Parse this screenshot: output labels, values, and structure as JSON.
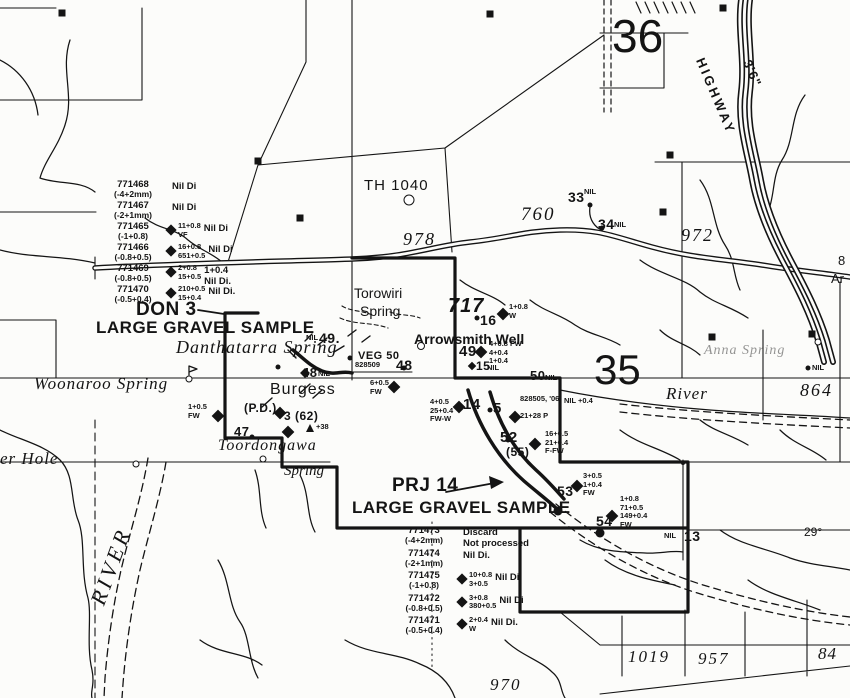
{
  "colors": {
    "ink": "#141414",
    "paper": "#fcfcfa"
  },
  "labels": [
    {
      "name": "section-number-36",
      "text": "36",
      "x": 612,
      "y": 12,
      "cls": "big",
      "fs": 46
    },
    {
      "name": "section-number-35",
      "text": "35",
      "x": 594,
      "y": 348,
      "cls": "big",
      "fs": 42
    },
    {
      "name": "label-th-1040",
      "text": "TH 1040",
      "x": 364,
      "y": 178,
      "cls": "typed",
      "fs": 15,
      "ls": 1
    },
    {
      "name": "elevation-978",
      "text": "978",
      "x": 403,
      "y": 230,
      "cls": "topo",
      "fs": 18,
      "ls": 2
    },
    {
      "name": "elevation-760",
      "text": "760",
      "x": 521,
      "y": 205,
      "cls": "topo",
      "fs": 19,
      "ls": 2
    },
    {
      "name": "elevation-972",
      "text": "972",
      "x": 681,
      "y": 226,
      "cls": "topo",
      "fs": 18,
      "ls": 2
    },
    {
      "name": "elevation-717",
      "text": "717",
      "x": 448,
      "y": 296,
      "cls": "hand-italic",
      "fs": 20
    },
    {
      "name": "elevation-864",
      "text": "864",
      "x": 800,
      "y": 381,
      "cls": "topo",
      "fs": 18,
      "ls": 2
    },
    {
      "name": "elevation-1019",
      "text": "1019",
      "x": 628,
      "y": 648,
      "cls": "topo",
      "fs": 17,
      "ls": 2
    },
    {
      "name": "elevation-957",
      "text": "957",
      "x": 698,
      "y": 650,
      "cls": "topo",
      "fs": 17,
      "ls": 2
    },
    {
      "name": "elevation-84",
      "text": "84",
      "x": 818,
      "y": 645,
      "cls": "topo",
      "fs": 17,
      "ls": 1
    },
    {
      "name": "elevation-970",
      "text": "970",
      "x": 490,
      "y": 676,
      "cls": "topo",
      "fs": 17,
      "ls": 2
    },
    {
      "name": "bearing-29",
      "text": "29°",
      "x": 804,
      "y": 526,
      "cls": "typed",
      "fs": 12
    },
    {
      "name": "edge-label-8",
      "text": "8",
      "x": 838,
      "y": 254,
      "cls": "typed",
      "fs": 13
    },
    {
      "name": "edge-label-ar",
      "text": "Ar",
      "x": 831,
      "y": 272,
      "cls": "typed",
      "fs": 13
    },
    {
      "name": "highway-label",
      "text": "HIGHWAY",
      "x": 706,
      "y": 56,
      "cls": "typed-bold",
      "fs": 13,
      "rot": 67,
      "ls": 3
    },
    {
      "name": "railway-gauge-label",
      "text": "3'6\"",
      "x": 753,
      "y": 58,
      "cls": "typed-bold",
      "fs": 13,
      "rot": 67,
      "ls": 1
    },
    {
      "name": "torowiri-spring-label",
      "text": "Torowiri",
      "x": 354,
      "y": 286,
      "cls": "typed",
      "fs": 14
    },
    {
      "name": "torowiri-spring-label-2",
      "text": "Spring",
      "x": 360,
      "y": 304,
      "cls": "typed",
      "fs": 14
    },
    {
      "name": "arrowsmith-well-label",
      "text": "Arrowsmith Well",
      "x": 414,
      "y": 332,
      "cls": "typed-bold",
      "fs": 14
    },
    {
      "name": "danthatarra-spring-label",
      "text": "Danthatarra  Spring",
      "x": 176,
      "y": 338,
      "cls": "name",
      "fs": 18,
      "ls": 1
    },
    {
      "name": "woonaroo-spring-label",
      "text": "Woonaroo  Spring",
      "x": 34,
      "y": 375,
      "cls": "name",
      "fs": 17,
      "ls": 1
    },
    {
      "name": "burgess-label",
      "text": "Burgess",
      "x": 270,
      "y": 382,
      "cls": "typed",
      "fs": 16,
      "ls": 1
    },
    {
      "name": "toordongawa-spring-label",
      "text": "Toordongawa",
      "x": 218,
      "y": 438,
      "cls": "name",
      "fs": 16,
      "ls": 1
    },
    {
      "name": "toordongawa-spring-label-2",
      "text": "Spring",
      "x": 284,
      "y": 464,
      "cls": "name",
      "fs": 15
    },
    {
      "name": "er-hole-label",
      "text": "er Hole",
      "x": 0,
      "y": 450,
      "cls": "name",
      "fs": 17,
      "ls": 1
    },
    {
      "name": "river-label",
      "text": "River",
      "x": 666,
      "y": 385,
      "cls": "name",
      "fs": 17,
      "ls": 1
    },
    {
      "name": "river-label-vertical",
      "text": "RIVER",
      "x": 86,
      "y": 600,
      "cls": "name",
      "fs": 22,
      "rot": -70,
      "ls": 4
    },
    {
      "name": "anna-spring-label",
      "text": "Anna Spring",
      "x": 704,
      "y": 344,
      "cls": "name",
      "fs": 14,
      "op": 0.45,
      "ls": 1
    },
    {
      "name": "don-3-label",
      "text": "DON 3",
      "x": 136,
      "y": 300,
      "cls": "hand",
      "fs": 19
    },
    {
      "name": "don-3-subtitle",
      "text": "LARGE GRAVEL SAMPLE",
      "x": 96,
      "y": 319,
      "cls": "hand",
      "fs": 17
    },
    {
      "name": "prj-14-label",
      "text": "PRJ 14",
      "x": 392,
      "y": 476,
      "cls": "hand",
      "fs": 19
    },
    {
      "name": "prj-14-subtitle",
      "text": "LARGE GRAVEL SAMPLE",
      "x": 352,
      "y": 499,
      "cls": "hand",
      "fs": 17
    },
    {
      "name": "station-49-nil-prefix",
      "text": "NIL",
      "x": 306,
      "y": 334,
      "cls": "tiny"
    },
    {
      "name": "station-49-label",
      "text": "49.",
      "x": 319,
      "y": 331,
      "cls": "hand",
      "fs": 14
    },
    {
      "name": "station-48b-label",
      "text": "48",
      "x": 302,
      "y": 366,
      "cls": "hand",
      "fs": 13
    },
    {
      "name": "station-48b-nil",
      "text": "NIL",
      "x": 318,
      "y": 370,
      "cls": "tiny"
    },
    {
      "name": "veg-50-label",
      "text": "VEG 50",
      "x": 358,
      "y": 351,
      "cls": "hand",
      "fs": 11
    },
    {
      "name": "sample-828509-label",
      "text": "828509",
      "x": 355,
      "y": 361,
      "cls": "tiny"
    },
    {
      "name": "station-48-label",
      "text": "48",
      "x": 396,
      "y": 358,
      "cls": "hand",
      "fs": 14
    },
    {
      "name": "annotation-6-05",
      "text": "6+0.5\nFW",
      "x": 370,
      "y": 379,
      "cls": "tiny"
    },
    {
      "name": "station-16-label",
      "text": "16",
      "x": 480,
      "y": 313,
      "cls": "hand",
      "fs": 14
    },
    {
      "name": "annotation-16",
      "text": "1+0.8\nW",
      "x": 509,
      "y": 303,
      "cls": "tiny"
    },
    {
      "name": "station-49-label-2",
      "text": "49",
      "x": 459,
      "y": 344,
      "cls": "hand",
      "fs": 15
    },
    {
      "name": "annotation-49",
      "text": "4+0.8 FW\n4+0.4\n1+0.4",
      "x": 489,
      "y": 340,
      "cls": "tiny"
    },
    {
      "name": "station-15-label",
      "text": "15",
      "x": 476,
      "y": 360,
      "cls": "hand",
      "fs": 12
    },
    {
      "name": "station-15-nil",
      "text": "NIL",
      "x": 487,
      "y": 364,
      "cls": "tiny"
    },
    {
      "name": "station-50-label",
      "text": "50",
      "x": 530,
      "y": 369,
      "cls": "hand",
      "fs": 13
    },
    {
      "name": "station-50-nil",
      "text": "NIL",
      "x": 545,
      "y": 374,
      "cls": "tiny"
    },
    {
      "name": "station-33-label",
      "text": "33",
      "x": 568,
      "y": 190,
      "cls": "hand",
      "fs": 14
    },
    {
      "name": "station-33-nil",
      "text": "NIL",
      "x": 584,
      "y": 188,
      "cls": "tiny"
    },
    {
      "name": "station-34-label",
      "text": "34",
      "x": 598,
      "y": 217,
      "cls": "hand",
      "fs": 14
    },
    {
      "name": "station-34-nil",
      "text": "NIL",
      "x": 614,
      "y": 221,
      "cls": "tiny"
    },
    {
      "name": "nil-annotation-east",
      "text": "NIL",
      "x": 812,
      "y": 364,
      "cls": "tiny"
    },
    {
      "name": "station-14-label",
      "text": "14",
      "x": 463,
      "y": 397,
      "cls": "hand",
      "fs": 15
    },
    {
      "name": "annotation-14",
      "text": "4+0.5\n25+0.4\nFW-W",
      "x": 430,
      "y": 398,
      "cls": "tiny"
    },
    {
      "name": "station-5-label",
      "text": "5",
      "x": 493,
      "y": 401,
      "cls": "hand",
      "fs": 15
    },
    {
      "name": "sample-828505-label",
      "text": "828505, '06",
      "x": 520,
      "y": 395,
      "cls": "tiny"
    },
    {
      "name": "annotation-nil-04",
      "text": "NIL +0.4",
      "x": 564,
      "y": 397,
      "cls": "tiny"
    },
    {
      "name": "annotation-5",
      "text": "21+28 P",
      "x": 520,
      "y": 412,
      "cls": "tiny"
    },
    {
      "name": "station-52-label",
      "text": "52",
      "x": 500,
      "y": 430,
      "cls": "hand",
      "fs": 15
    },
    {
      "name": "station-52-sub",
      "text": "(55)",
      "x": 506,
      "y": 446,
      "cls": "hand",
      "fs": 12
    },
    {
      "name": "annotation-52",
      "text": "16+0.5\n21+0.4\nF-FW",
      "x": 545,
      "y": 430,
      "cls": "tiny"
    },
    {
      "name": "station-53-label",
      "text": "53",
      "x": 557,
      "y": 484,
      "cls": "hand",
      "fs": 14
    },
    {
      "name": "annotation-53",
      "text": "3+0.5\n1+0.4\nFW",
      "x": 583,
      "y": 472,
      "cls": "tiny"
    },
    {
      "name": "station-54-label",
      "text": "54",
      "x": 596,
      "y": 514,
      "cls": "hand",
      "fs": 14
    },
    {
      "name": "annotation-54",
      "text": "1+0.8\n71+0.5\n149+0.4\nFW",
      "x": 620,
      "y": 495,
      "cls": "tiny"
    },
    {
      "name": "station-13-nil",
      "text": "NIL",
      "x": 664,
      "y": 532,
      "cls": "tiny"
    },
    {
      "name": "station-13-label",
      "text": "13",
      "x": 684,
      "y": 529,
      "cls": "hand",
      "fs": 14
    },
    {
      "name": "station-47-label",
      "text": "47",
      "x": 234,
      "y": 425,
      "cls": "hand",
      "fs": 13
    },
    {
      "name": "pd-label",
      "text": "(P.D.)",
      "x": 244,
      "y": 402,
      "cls": "hand",
      "fs": 12
    },
    {
      "name": "station-3-62-label",
      "text": "3 (62)",
      "x": 284,
      "y": 410,
      "cls": "hand",
      "fs": 12
    },
    {
      "name": "annotation-1-05",
      "text": "1+0.5\nFW",
      "x": 188,
      "y": 403,
      "cls": "tiny"
    },
    {
      "name": "annotation-plus-38",
      "text": "+38",
      "x": 316,
      "y": 423,
      "cls": "tiny"
    }
  ],
  "samples_top": {
    "rows": [
      {
        "id": "771468",
        "fraction": "(-4+2mm)",
        "d": false,
        "values": "",
        "note": "Nil Di"
      },
      {
        "id": "771467",
        "fraction": "(-2+1mm)",
        "d": false,
        "values": "",
        "note": "Nil Di"
      },
      {
        "id": "771465",
        "fraction": "(-1+0.8)",
        "d": true,
        "values": "11+0.8\nVF",
        "note": "Nil Di"
      },
      {
        "id": "771466",
        "fraction": "(-0.8+0.5)",
        "d": true,
        "values": "16+0.8\n651+0.5",
        "note": "Nil Di"
      },
      {
        "id": "771469",
        "fraction": "(-0.8+0.5)",
        "d": true,
        "values": "2+0.8\n15+0.5",
        "note": "1+0.4\nNil Di."
      },
      {
        "id": "771470",
        "fraction": "(-0.5+0.4)",
        "d": true,
        "values": "210+0.5\n15+0.4",
        "note": "Nil Di."
      }
    ]
  },
  "samples_bottom": {
    "rows": [
      {
        "id": "771473",
        "fraction": "(-4+2mm)",
        "d": false,
        "values": "",
        "note": "Discard\nNot processed"
      },
      {
        "id": "771474",
        "fraction": "(-2+1mm)",
        "d": false,
        "values": "",
        "note": "Nil Di."
      },
      {
        "id": "771475",
        "fraction": "(-1+0.8)",
        "d": true,
        "values": "10+0.8\n3+0.5",
        "note": "Nil Di."
      },
      {
        "id": "771472",
        "fraction": "(-0.8+0.5)",
        "d": true,
        "values": "3+0.8\n380+0.5",
        "note": "Nil Di"
      },
      {
        "id": "771471",
        "fraction": "(-0.5+0.4)",
        "d": true,
        "values": "2+0.4\nW",
        "note": "Nil Di."
      }
    ]
  },
  "markers": {
    "diamonds": [
      {
        "x": 394,
        "y": 387
      },
      {
        "x": 503,
        "y": 314
      },
      {
        "x": 481,
        "y": 352
      },
      {
        "x": 459,
        "y": 407
      },
      {
        "x": 515,
        "y": 417
      },
      {
        "x": 535,
        "y": 444
      },
      {
        "x": 577,
        "y": 486
      },
      {
        "x": 612,
        "y": 516
      },
      {
        "x": 280,
        "y": 413
      },
      {
        "x": 288,
        "y": 432
      },
      {
        "x": 218,
        "y": 416
      },
      {
        "x": 472,
        "y": 366,
        "s": 6
      },
      {
        "x": 305,
        "y": 373,
        "s": 7
      }
    ],
    "dots": [
      {
        "x": 590,
        "y": 205
      },
      {
        "x": 602,
        "y": 228
      },
      {
        "x": 278,
        "y": 367
      },
      {
        "x": 350,
        "y": 358
      },
      {
        "x": 404,
        "y": 368
      },
      {
        "x": 477,
        "y": 318
      },
      {
        "x": 490,
        "y": 410
      },
      {
        "x": 508,
        "y": 440
      },
      {
        "x": 252,
        "y": 437
      },
      {
        "x": 558,
        "y": 511,
        "s": 9
      },
      {
        "x": 600,
        "y": 533,
        "s": 9
      },
      {
        "x": 808,
        "y": 368
      },
      {
        "x": 683,
        "y": 463,
        "s": 4
      }
    ],
    "squares": [
      {
        "x": 62,
        "y": 13
      },
      {
        "x": 490,
        "y": 14
      },
      {
        "x": 723,
        "y": 8
      },
      {
        "x": 258,
        "y": 161
      },
      {
        "x": 300,
        "y": 218
      },
      {
        "x": 663,
        "y": 212
      },
      {
        "x": 670,
        "y": 155
      },
      {
        "x": 712,
        "y": 337
      },
      {
        "x": 812,
        "y": 334
      }
    ],
    "circles": [
      {
        "x": 409,
        "y": 200,
        "s": 11
      },
      {
        "x": 421,
        "y": 346,
        "s": 8
      },
      {
        "x": 189,
        "y": 379,
        "s": 7
      },
      {
        "x": 263,
        "y": 459,
        "s": 7
      },
      {
        "x": 136,
        "y": 464,
        "s": 7
      },
      {
        "x": 818,
        "y": 342,
        "s": 7
      }
    ],
    "triangles": [
      {
        "x": 310,
        "y": 428
      }
    ]
  }
}
